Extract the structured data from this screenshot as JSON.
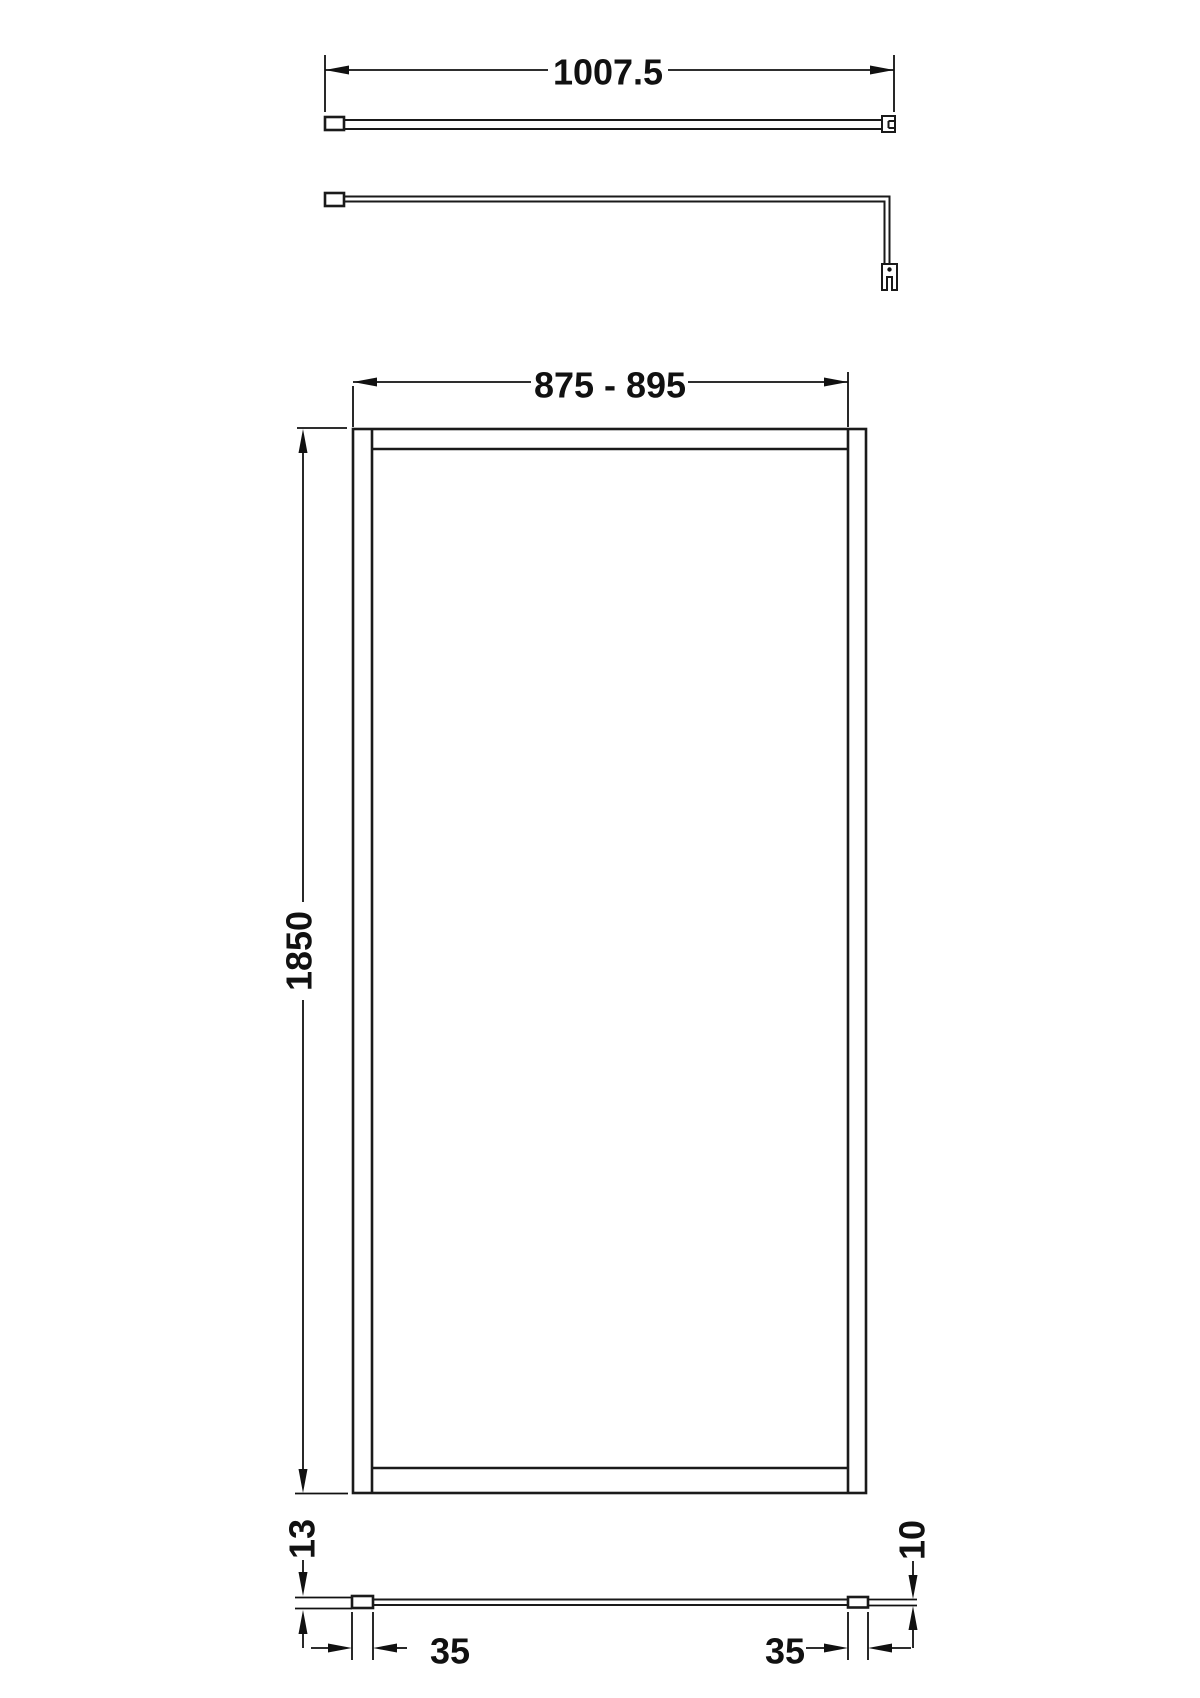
{
  "drawing": {
    "dims": {
      "arm_length": "1007.5",
      "screen_width_range": "875 - 895",
      "screen_height": "1850",
      "channel_depth": "13",
      "glass_thickness": "10",
      "left_profile_width": "35",
      "right_profile_width": "35"
    }
  }
}
